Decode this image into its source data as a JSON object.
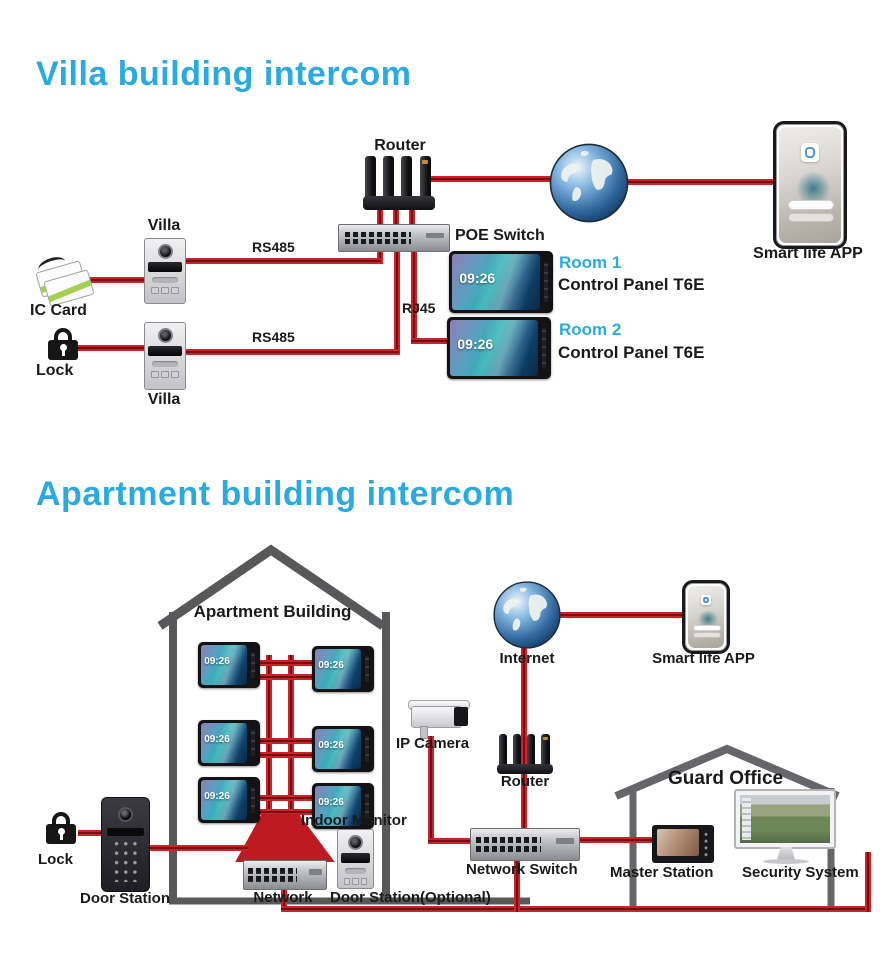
{
  "colors": {
    "accent_cyan": "#29abe2",
    "line_red": "#cf2128",
    "line_red_dark": "#731014",
    "label_black": "#1a1a1a",
    "house_gray": "#58585a"
  },
  "shared": {
    "clock": "09:26"
  },
  "villa": {
    "title": "Villa building intercom",
    "router": "Router",
    "poe_switch": "POE Switch",
    "villa_top": "Villa",
    "villa_bottom": "Villa",
    "ic_card": "IC Card",
    "lock": "Lock",
    "rs485_top": "RS485",
    "rs485_bottom": "RS485",
    "rj45": "RJ45",
    "room1": "Room 1",
    "room1_device": "Control Panel T6E",
    "room2": "Room 2",
    "room2_device": "Control Panel T6E",
    "smart_app": "Smart life APP"
  },
  "apartment": {
    "title": "Apartment building intercom",
    "building": "Apartment Building",
    "internet": "Internet",
    "smart_app": "Smart life APP",
    "ip_camera": "IP Camera",
    "router": "Router",
    "indoor_monitor": "Indoor Monitor",
    "network": "Network",
    "network_switch": "Network Switch",
    "door_station_optional": "Door Station(Optional)",
    "lock": "Lock",
    "door_station": "Door Station",
    "guard_office": "Guard Office",
    "master_station": "Master Station",
    "security_system": "Security System"
  }
}
